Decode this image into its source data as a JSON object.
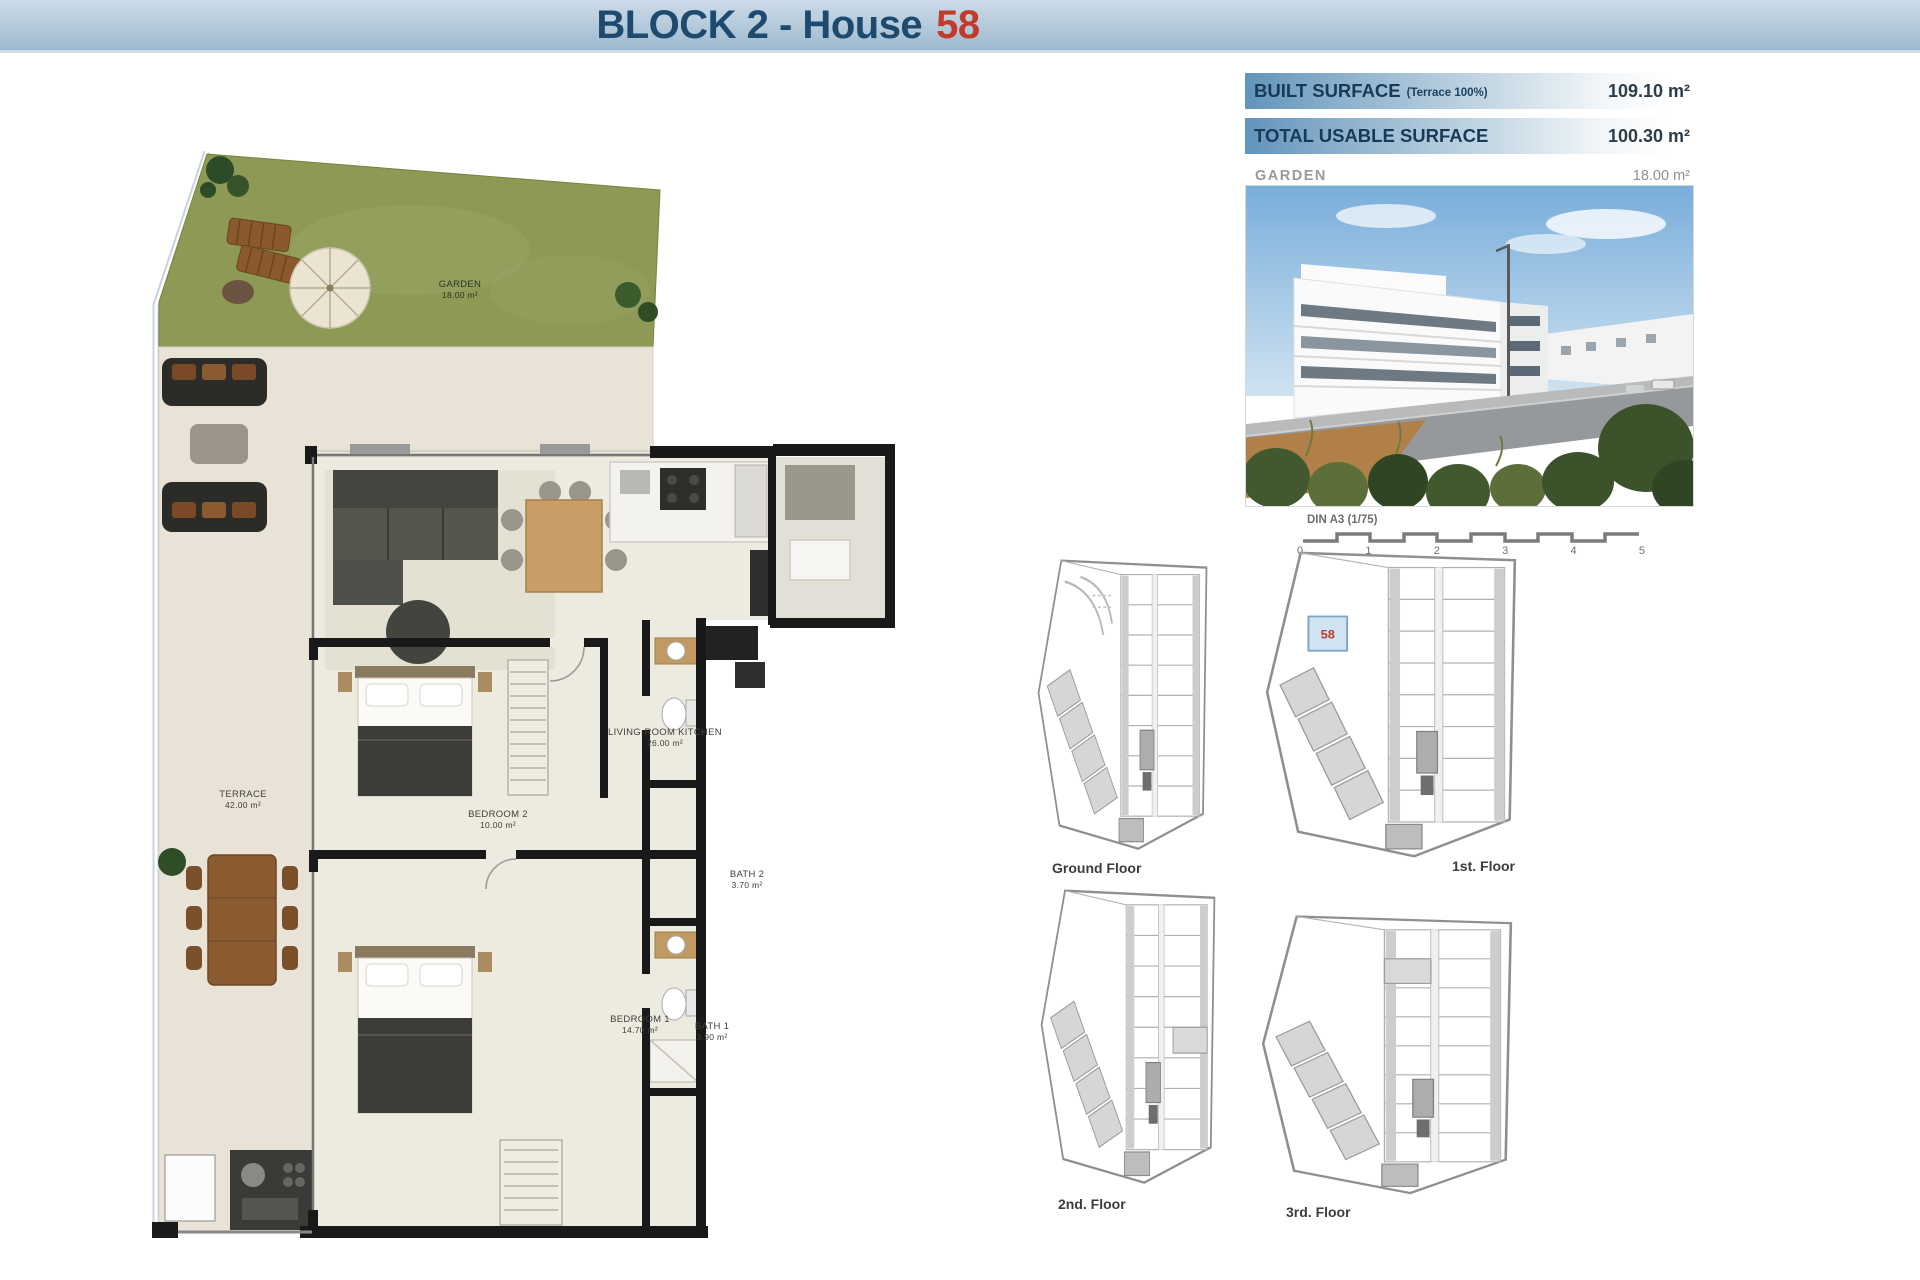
{
  "header": {
    "title": "BLOCK 2 - House",
    "house_number": "58"
  },
  "surface_table": {
    "rows": [
      {
        "label": "BUILT SURFACE",
        "note": "(Terrace 100%)",
        "value": "109.10 m²"
      },
      {
        "label": "TOTAL USABLE SURFACE",
        "note": "",
        "value": "100.30 m²"
      }
    ],
    "garden": {
      "label": "GARDEN",
      "value": "18.00 m²"
    }
  },
  "plan": {
    "rooms": {
      "garden": {
        "name": "GARDEN",
        "area": "18.00 m²"
      },
      "terrace": {
        "name": "TERRACE",
        "area": "42.00 m²"
      },
      "living": {
        "name": "LIVING-ROOM KITCHEN",
        "area": "26.00 m²"
      },
      "bedroom2": {
        "name": "BEDROOM 2",
        "area": "10.00 m²"
      },
      "bedroom1": {
        "name": "BEDROOM 1",
        "area": "14.70 m²"
      },
      "bath2": {
        "name": "BATH 2",
        "area": "3.70 m²"
      },
      "bath1": {
        "name": "BATH 1",
        "area": "3.90 m²"
      }
    }
  },
  "scale_bar": {
    "label": "DIN A3 (1/75)",
    "ticks": [
      "0",
      "1",
      "2",
      "3",
      "4",
      "5"
    ]
  },
  "floors": [
    {
      "label": "Ground Floor"
    },
    {
      "label": "1st. Floor",
      "highlight_number": "58"
    },
    {
      "label": "2nd. Floor"
    },
    {
      "label": "3rd. Floor"
    }
  ],
  "colors": {
    "header_blue": "#1d4a6e",
    "house_number_red": "#c23b2a",
    "bar_blue": "#6194bc",
    "garden_green": "#8d9954",
    "highlight_cell_blue": "#cfe3f3"
  }
}
